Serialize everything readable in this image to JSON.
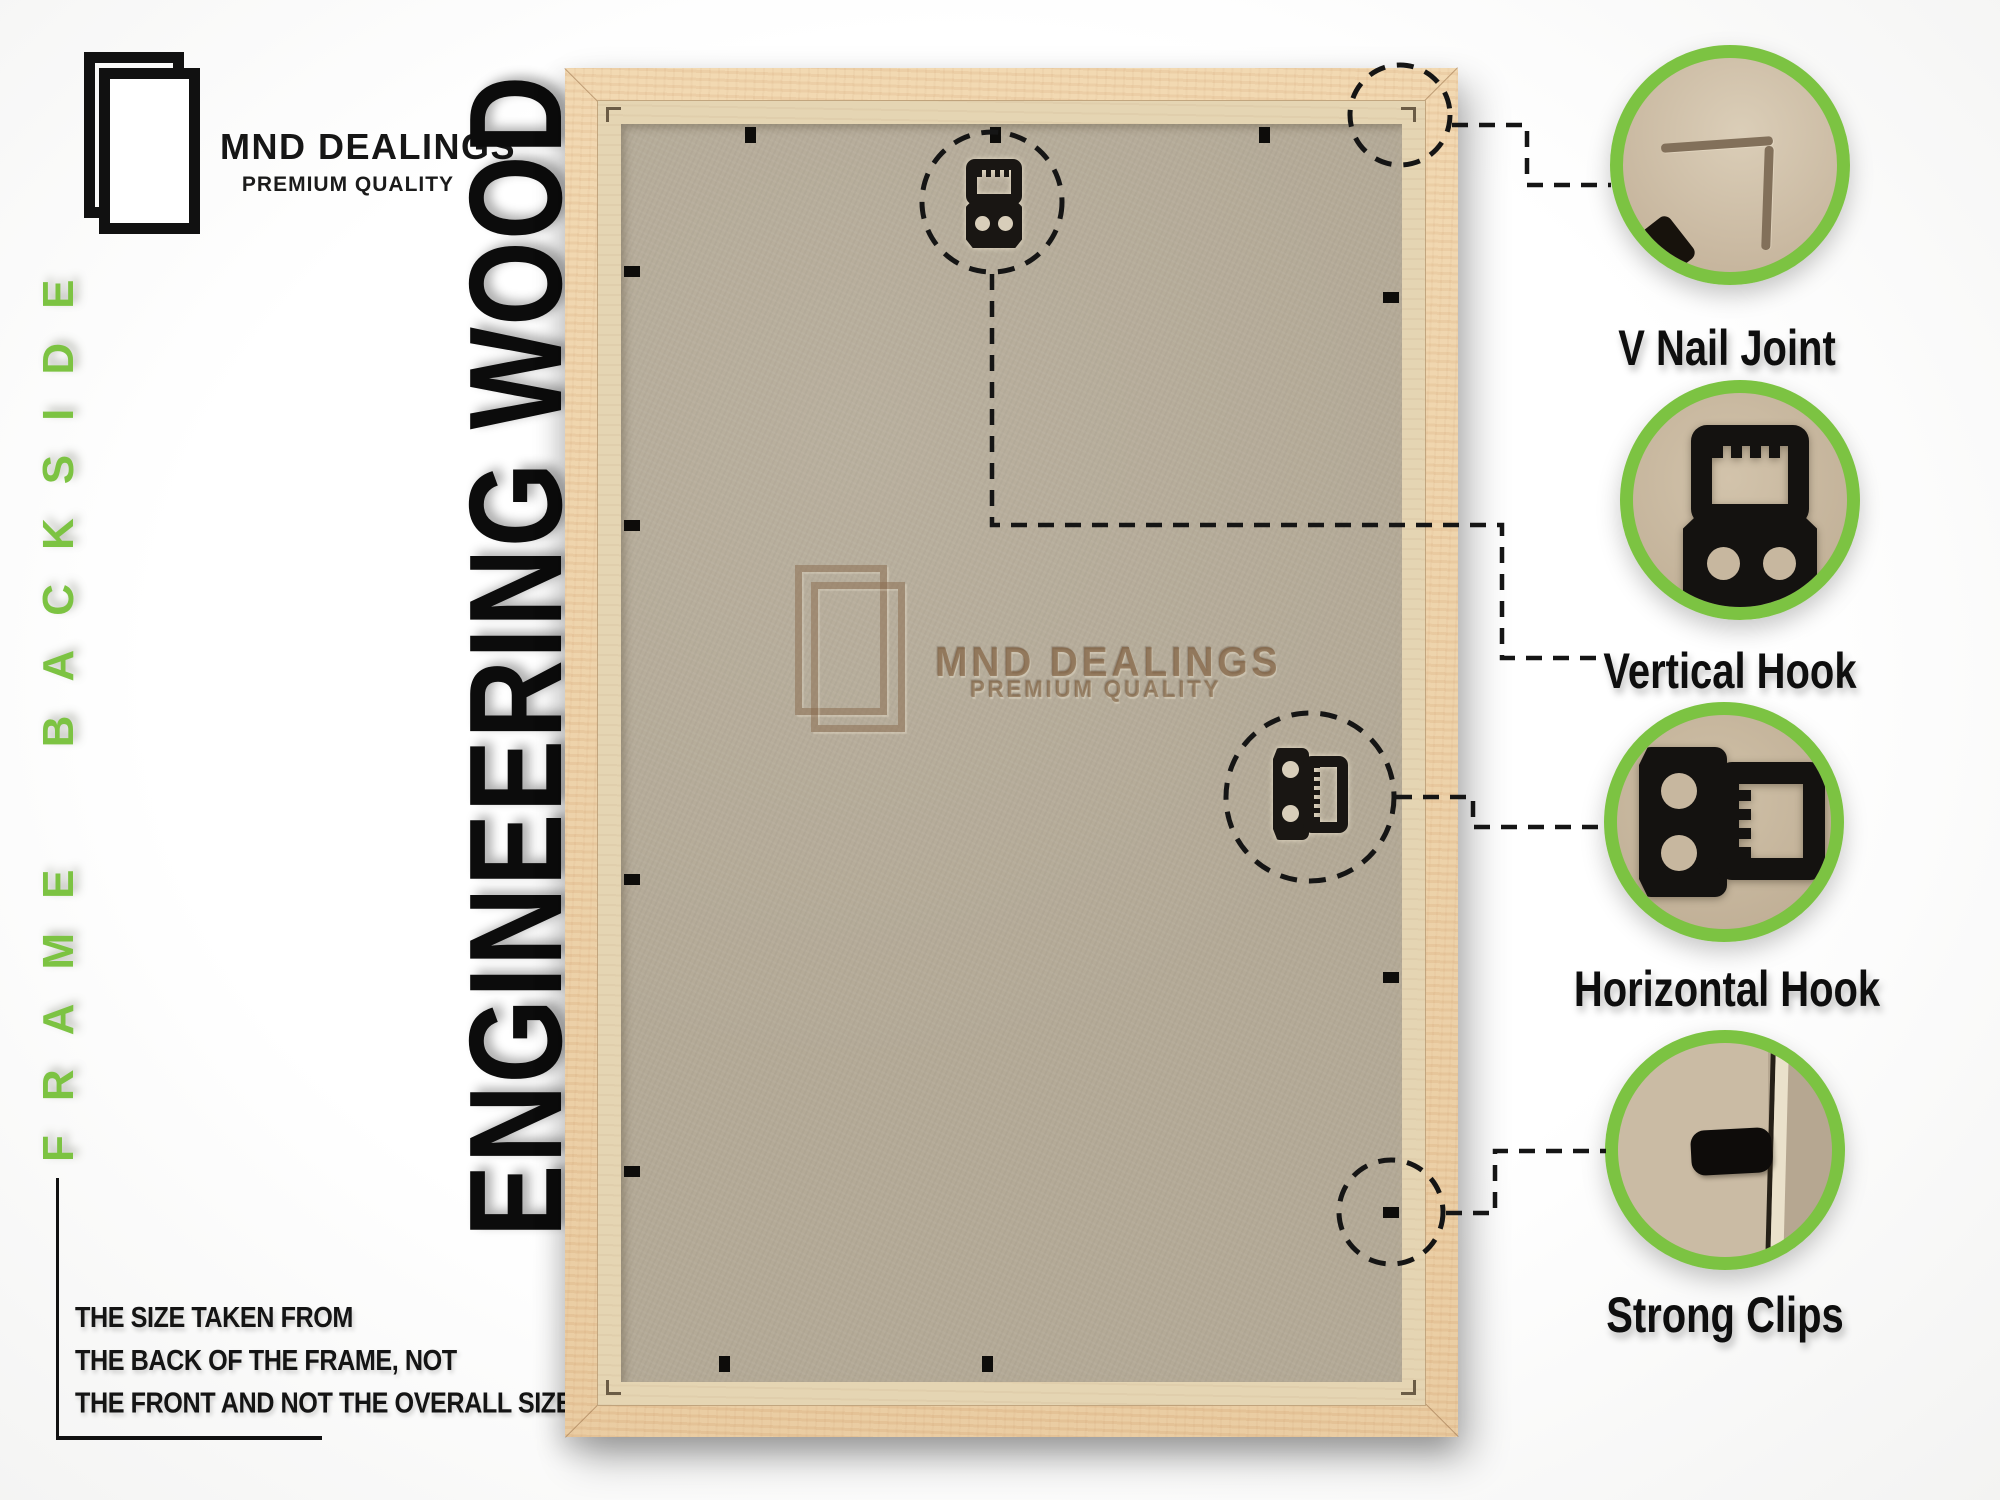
{
  "brand": {
    "name": "MND DEALINGS",
    "tagline": "PREMIUM QUALITY"
  },
  "left_panel": {
    "side_label": "FRAME BACKSIDE",
    "big_title": "ENGINEERING WOOD",
    "note_lines": [
      "THE SIZE TAKEN FROM",
      "THE BACK OF THE FRAME, NOT",
      "THE FRONT AND NOT THE OVERALL SIZE."
    ]
  },
  "frame": {
    "watermark": {
      "name": "MND DEALINGS",
      "tagline": "PREMIUM QUALITY"
    }
  },
  "callouts": [
    {
      "id": "v-nail-joint",
      "label": "V Nail Joint"
    },
    {
      "id": "vertical-hook",
      "label": "Vertical Hook"
    },
    {
      "id": "horizontal-hook",
      "label": "Horizontal Hook"
    },
    {
      "id": "strong-clips",
      "label": "Strong Clips"
    }
  ],
  "icons": {
    "brand_logo": "double-frame-outline",
    "watermark_logo": "double-frame-outline-embossed",
    "vertical_hook": "sawtooth-hanger-vertical",
    "horizontal_hook": "sawtooth-hanger-horizontal",
    "strong_clip": "flexi-tab-clip",
    "v_nail": "corner-v-nail-groove"
  },
  "colors": {
    "accent_green": "#7cc342",
    "ink": "#121212",
    "wood": "#eccfa6",
    "rebate": "#e5d5b3",
    "panel": "#b4aa97",
    "watermark_ink": "#80604 0"
  }
}
